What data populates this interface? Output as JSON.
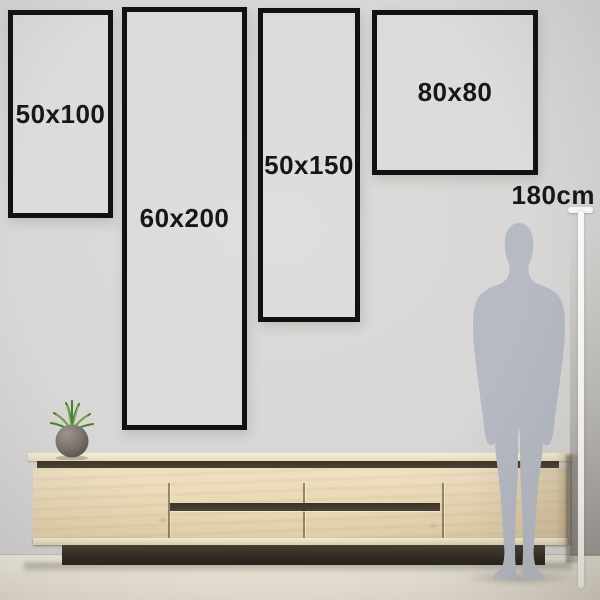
{
  "frames": [
    {
      "label": "50x100"
    },
    {
      "label": "60x200"
    },
    {
      "label": "50x150"
    },
    {
      "label": "80x80"
    }
  ],
  "height_marker": {
    "label": "180cm"
  },
  "icons": {
    "person": "person-silhouette",
    "plant": "potted-plant",
    "measure": "height-measure-line"
  },
  "colors": {
    "frame_border": "#111111",
    "label_text": "#171717",
    "wall": "#d7d6d4",
    "floor": "#eae4d7",
    "wood_light": "#ead9b7",
    "wood_groove_dark": "#4c4334",
    "plinth_dark": "#2e2922",
    "silhouette_gray": "#b6bac3",
    "measure_line_white": "#ffffff",
    "plant_green": "#5e8f3f",
    "pot_gray": "#7a736d"
  }
}
